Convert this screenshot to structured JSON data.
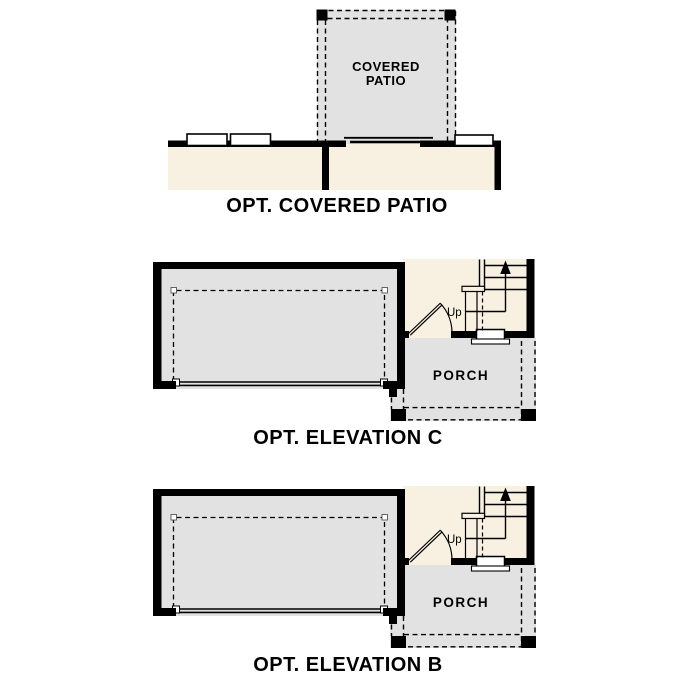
{
  "document_type": "floor-plan-options-sheet",
  "colors": {
    "background": "#ffffff",
    "wall": "#000000",
    "interior_beige": "#f8f0e1",
    "concrete_gray": "#e2e2e2",
    "line": "#000000"
  },
  "covered_patio_plan": {
    "room_label_line1": "COVERED",
    "room_label_line2": "PATIO",
    "caption": "OPT. COVERED PATIO"
  },
  "elevation": {
    "porch_label": "PORCH",
    "up_label": "Up"
  },
  "elevation_c_plan": {
    "caption": "OPT. ELEVATION C"
  },
  "elevation_b_plan": {
    "caption": "OPT. ELEVATION B"
  }
}
